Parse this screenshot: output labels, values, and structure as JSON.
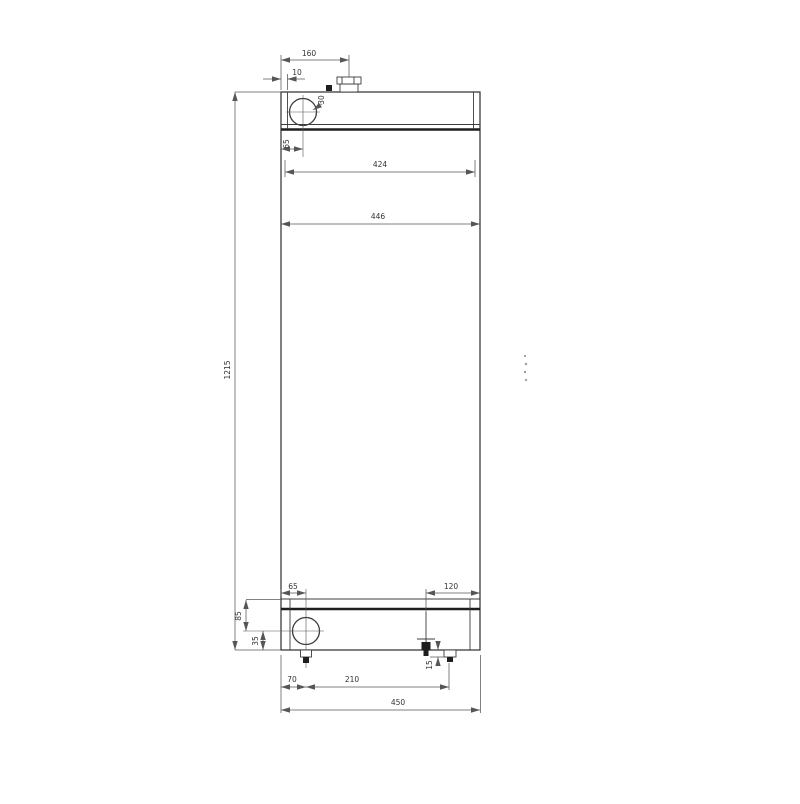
{
  "colors": {
    "bg": "#ffffff",
    "outline": "#3c3c3c",
    "heavy": "#1e1e1e",
    "dim": "#565656",
    "text": "#333333",
    "artifact": "#9a9a9a"
  },
  "drawing": {
    "type": "technical-drawing",
    "subject": "radiator-front-view",
    "dims": {
      "neck_offset": "160",
      "edge_inset": "10",
      "top_port_dia": "30",
      "top_port_offset": "65",
      "core_width": "424",
      "tank_width": "446",
      "overall_height": "1215",
      "bottom_port_offset": "65",
      "right_fitting_inset": "120",
      "header_depth": "85",
      "port_center_height": "35",
      "stub_length": "15",
      "drain_offset": "70",
      "fitting_span": "210",
      "overall_width": "450"
    }
  }
}
